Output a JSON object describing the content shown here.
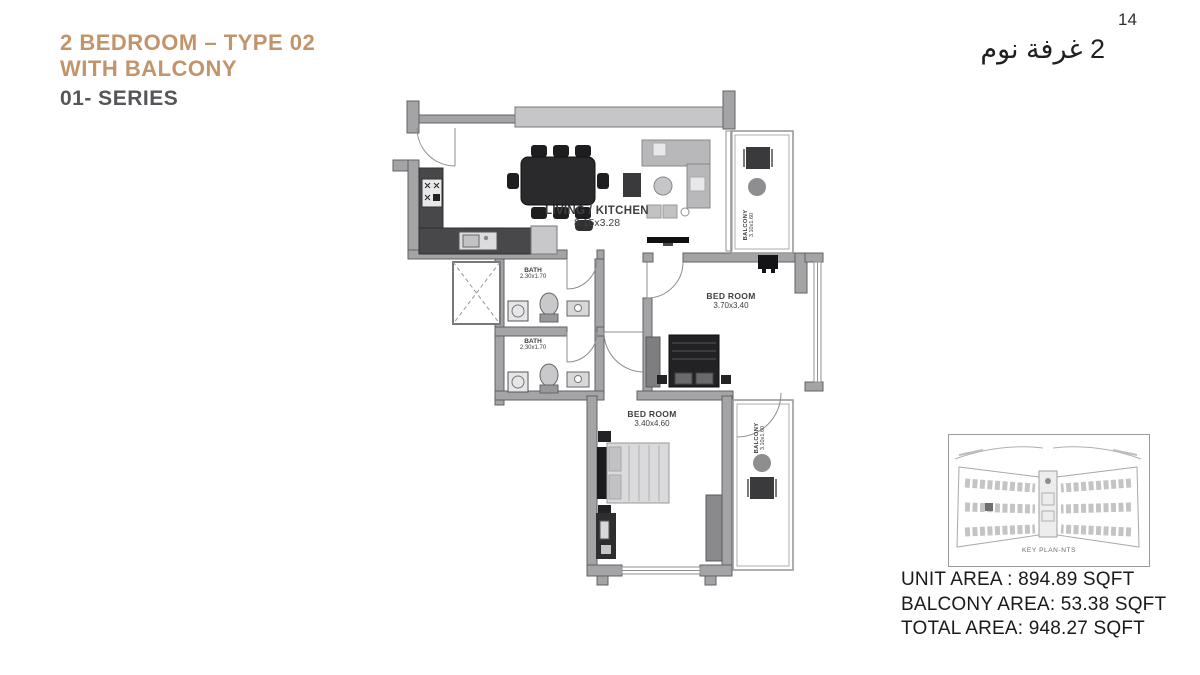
{
  "page": {
    "number": "14",
    "background": "#FFFFFF"
  },
  "header": {
    "title_line1": "2 BEDROOM – TYPE 02",
    "title_line2": "WITH BALCONY",
    "series": "01- SERIES",
    "arabic_title": "2 غرفة نوم",
    "accent_color": "#C2946B",
    "series_color": "#55565A"
  },
  "plan": {
    "rooms": {
      "living": {
        "name": "LIVING / KITCHEN",
        "dims": "8.15x3.28"
      },
      "bath_top": {
        "name": "BATH",
        "dims": "2.30x1.70"
      },
      "bath_bottom": {
        "name": "BATH",
        "dims": "2.30x1.70"
      },
      "bedroom_right": {
        "name": "BED ROOM",
        "dims": "3.70x3.40"
      },
      "bedroom_bottom": {
        "name": "BED ROOM",
        "dims": "3.40x4.60"
      },
      "balcony_top": {
        "name": "BALCONY",
        "dims": "3.10x1.60"
      },
      "balcony_bottom": {
        "name": "BALCONY",
        "dims": "3.10x1.60"
      }
    },
    "wall_color": "#A4A4A6",
    "counter_color": "#48484A"
  },
  "key_plan": {
    "caption": "KEY PLAN-NTS"
  },
  "areas": {
    "unit": "UNIT AREA : 894.89 SQFT",
    "balcony": "BALCONY AREA: 53.38 SQFT",
    "total": "TOTAL AREA: 948.27 SQFT"
  }
}
